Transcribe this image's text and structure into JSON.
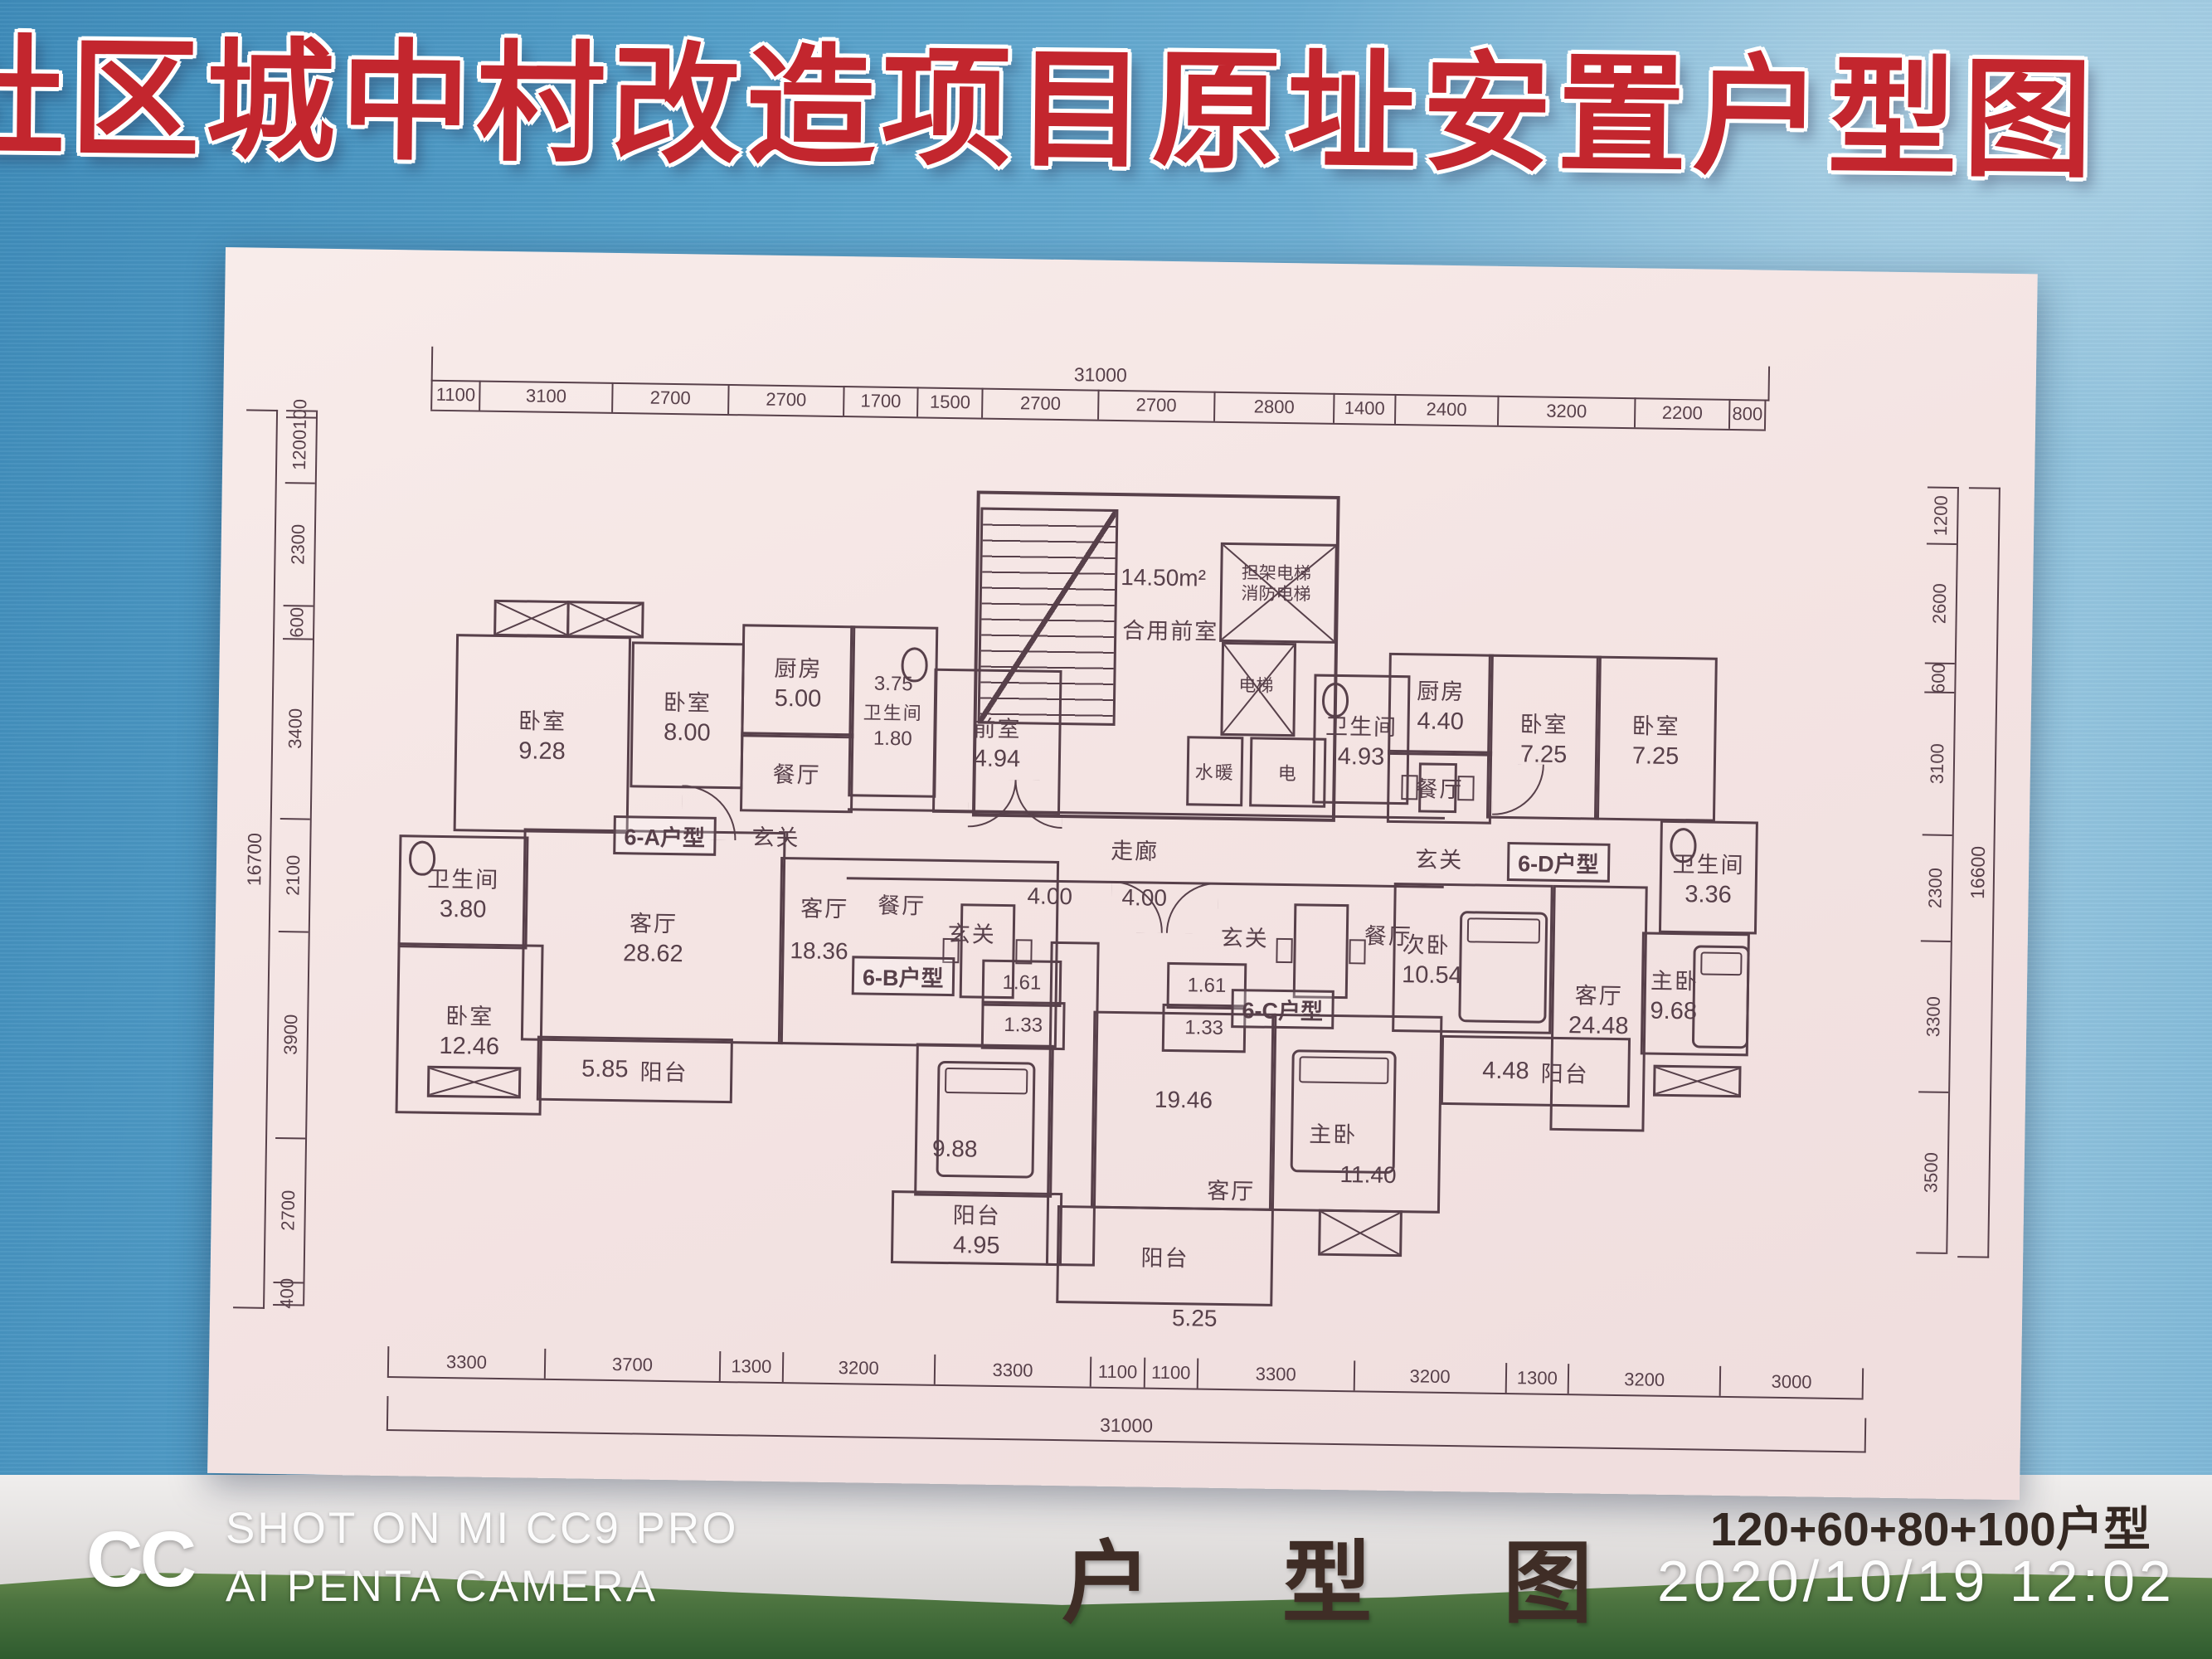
{
  "billboard": {
    "title": "社区城中村改造项目原址安置户型图"
  },
  "watermark": {
    "logo": "CC",
    "line1": "SHOT ON MI CC9 PRO",
    "line2": "AI PENTA CAMERA"
  },
  "footer": {
    "plan_title": "户型图",
    "unit_mix": "120+60+80+100户型",
    "timestamp": "2020/10/19  12:02"
  },
  "dimensions": {
    "top": {
      "overall": "31000",
      "segments": [
        "1100",
        "3100",
        "2700",
        "2700",
        "1700",
        "1500",
        "2700",
        "2700",
        "2800",
        "1400",
        "2400",
        "3200",
        "2200",
        "800"
      ]
    },
    "bottom": {
      "overall": "31000",
      "segments": [
        "3300",
        "3700",
        "1300",
        "3200",
        "3300",
        "1100",
        "1100",
        "3300",
        "3200",
        "1300",
        "3200",
        "3000"
      ]
    },
    "left": {
      "overall": "16700",
      "segments": [
        "100",
        "1200",
        "2300",
        "600",
        "3400",
        "2100",
        "3900",
        "2700",
        "400"
      ]
    },
    "right": {
      "overall": "16600",
      "segments": [
        "1200",
        "2600",
        "600",
        "3100",
        "2300",
        "3300",
        "3500"
      ]
    }
  },
  "core": {
    "vestibule_area": "14.50m²",
    "vestibule": "合用前室",
    "lift_main_l1": "担架电梯",
    "lift_main_l2": "消防电梯",
    "lift": "电梯",
    "water": "水暖",
    "power": "电",
    "corridor": "走廊",
    "front": {
      "name": "前室",
      "area": "4.94"
    },
    "bath": {
      "name": "卫生间",
      "area": "4.93"
    }
  },
  "units": {
    "a": {
      "badge": "6-A户型",
      "bed1": {
        "name": "卧室",
        "area": "9.28"
      },
      "bed2": {
        "name": "卧室",
        "area": "8.00"
      },
      "kitchen": {
        "name": "厨房",
        "area": "5.00"
      },
      "dining": {
        "name": "餐厅"
      },
      "hall": {
        "name": "玄关"
      },
      "bath": {
        "name": "卫生间",
        "area": "3.80"
      },
      "bath2": {
        "name": "卫生间",
        "area": "3.75",
        "wc": "1.80"
      },
      "bed3": {
        "name": "卧室",
        "area": "12.46"
      },
      "living": {
        "name": "客厅",
        "area": "28.62"
      },
      "balcony": {
        "name": "阳台",
        "area": "5.85"
      }
    },
    "b": {
      "badge": "6-B户型",
      "living": {
        "name": "客厅",
        "area": "18.36"
      },
      "dining": {
        "name": "餐厅"
      },
      "hall": {
        "name": "玄关",
        "area": "4.00"
      },
      "w1": "1.61",
      "w2": "1.33",
      "bed": {
        "area": "9.88"
      },
      "balcony": {
        "name": "阳台",
        "area": "4.95"
      }
    },
    "c": {
      "badge": "6-C户型",
      "hall": {
        "name": "玄关",
        "area": "4.00"
      },
      "dining": {
        "name": "餐厅"
      },
      "w1": "1.61",
      "w2": "1.33",
      "living": {
        "name": "客厅",
        "area": "19.46"
      },
      "master": {
        "name": "主卧",
        "area": "11.40"
      },
      "balcony": {
        "name": "阳台",
        "area": "5.25"
      }
    },
    "d": {
      "badge": "6-D户型",
      "kitchen": {
        "name": "厨房",
        "area": "4.40"
      },
      "dining": {
        "name": "餐厅"
      },
      "hall": {
        "name": "玄关"
      },
      "bed1": {
        "name": "卧室",
        "area": "7.25"
      },
      "bed2": {
        "name": "卧室",
        "area": "7.25"
      },
      "bath": {
        "name": "卫生间",
        "area": "3.36"
      },
      "second": {
        "name": "次卧",
        "area": "10.54"
      },
      "living": {
        "name": "客厅",
        "area": "24.48"
      },
      "master": {
        "name": "主卧",
        "area": "9.68"
      },
      "balcony": {
        "name": "阳台",
        "area": "4.48"
      }
    }
  }
}
